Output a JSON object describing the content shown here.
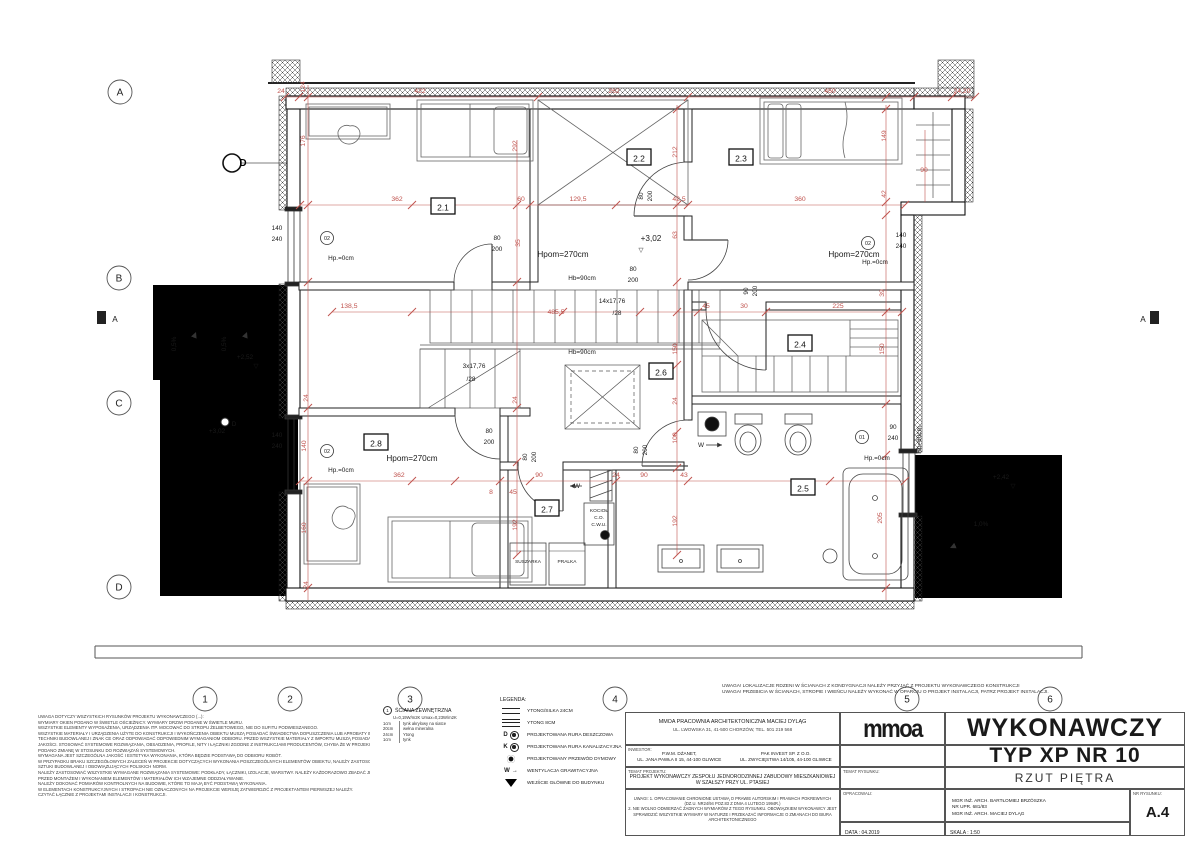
{
  "doc": {
    "office_line1": "MMOA PRACOWNIA ARCHITEKTONICZNA MACIEJ DYLĄG",
    "office_line2": "UL. LWOWSKA 31, 41-500 CHORZÓW, TEL. 501 219 568",
    "logo": "mmoa",
    "inwestor_label": "INWESTOR:",
    "inwestor1_line1": "P.W.M. DŻANET,",
    "inwestor1_line2": "UL. JANA PAWŁA II 15, 44-100 GLIWICE",
    "inwestor2_line1": "PAK INVEST SP. Z O.O.",
    "inwestor2_line2": "UL. ZWYCIĘSTWA 14/105, 44-100 GLIWICE",
    "temat_label": "TEMAT PROJEKTU:",
    "temat_line1": "PROJEKT WYKONAWCZY ZESPOŁU JEDNORODZINNEJ ZABUDOWY MIESZKANIOWEJ",
    "temat_line2": "W SZAŁSZY PRZY UL. PTASIEJ",
    "uwagi_lines": [
      "UWAGI: 1. OPRACOWANIE CHRONIONE USTAWĄ O PRAWIE AUTORSKIM I PRAWACH POKREWNYCH",
      "(DZ.U. NR24/94 POZ.83 Z DNIA 4 LUTEGO 1994R.)",
      "2. NIE WOLNO ODMIERZAĆ ŻADNYCH WYMIARÓW Z TEGO RYSUNKU. OBOWIĄZKIEM WYKONAWCY JEST",
      "SPRAWDZIĆ WSZYSTKIE WYMIARY W NATURZE I PRZEKAZAĆ INFORMACJE O ZMIANACH DO BIURA",
      "ARCHITEKTONICZNEGO"
    ],
    "title_big1": "WYKONAWCZY",
    "title_big2": "TYP XP  NR  10",
    "temat_rys_label": "TEMAT RYSUNKU:",
    "temat_rys": "RZUT PIĘTRA",
    "oprac_label": "OPRACOWALI:",
    "oprac_lines": [
      "MGR INŻ. ARCH. BARTŁOMIEJ BRZÓSZKA",
      "NR UPR. 681/83",
      "MGR INŻ. ARCH. MACIEJ DYLĄG"
    ],
    "nr_rys_label": "NR RYSUNKU:",
    "nr_rys": "A.4",
    "data_label": "DATA :",
    "data_value": "04.2019",
    "skala_label": "SKALA :",
    "skala_value": "1:50"
  },
  "remarks": [
    "UWAGA! LOKALIZACJE RDZENI W ŚCIANACH Z KONDYGNACJI NALEŻY PRZYJĄĆ Z PROJEKTU WYKONAWCZEGO KONSTRUKCJI",
    "UWAGA! PRZEBICIA W ŚCIANACH, STROPIE I WIEŃCU NALEŻY WYKONAĆ W OPARCIU O PROJEKT INSTALACJI, PATRZ PROJEKT INSTALACJI."
  ],
  "notes": [
    "UWAGA DOTYCZY WSZYSTKICH RYSUNKÓW PROJEKTU WYKONAWCZEGO (...):",
    "WYMIARY OKIEN PODANO W ŚWIETLE OŚCIEŻNICY. WYMIARY DRZWI PODANE W ŚWIETLE MURU.",
    "WSZYSTKIE ELEMENTY WYPOSAŻENIA, URZĄDZENIA ITP. MOCOWAĆ DO STROPU ŻELBETOWEGO, NIE DO SUFITU PODWIESZANEGO.",
    "WSZYSTKIE MATERIAŁY I URZĄDZENIA UŻYTE DO KONSTRUKCJI I WYKOŃCZENIA OBIEKTU MUSZĄ POSIADAĆ ŚWIADECTWA DOPUSZCZENIA LUB APROBATY INSTYTUTU",
    "TECHNIKI BUDOWLANEJ I ZNAK CE ORAZ ODPOWIADAĆ ODPOWIEDNIM WYMAGANIOM ODBIORU. PRZED WSZYSTKIE MATERIAŁY Z IMPORTU MUSZĄ POSIADAĆ ŚWIADECTWO",
    "JAKOŚCI. STOSOWAĆ SYSTEMOWE ROZWIĄZANIA, OBSADZENIA, PROFILE, NITY I ŁĄCZNIKI ZGODNE Z INSTRUKCJAMI PRODUCENTÓW, CHYBA ŻE W PROJEKCIE WYRAŹNIE",
    "PODANO ZMIANĘ W STOSUNKU DO ROZWIĄZAŃ SYSTEMOWYCH.",
    "WYMAGANA JEST SZCZEGÓLNA JAKOŚĆ I ESTETYKA WYKONANIA, KTÓRA BĘDZIE PODSTAWĄ DO ODBIORU ROBÓT.",
    "W PRZYPADKU BRAKU SZCZEGÓŁOWYCH ZALECEŃ W PROJEKCIE DOTYCZĄCYCH WYKONANIA POSZCZEGÓLNYCH ELEMENTÓW OBIEKTU, NALEŻY ZASTOSOWAĆ ZASADY",
    "SZTUKI BUDOWLANEJ I OBOWIĄZUJĄCYCH POLSKICH NORM.",
    "NALEŻY ZASTOSOWAĆ WSZYSTKIE WYMAGANE ROZWIĄZANIA SYSTEMOWE: PODKŁADY, ŁĄCZNIKI, IZOLACJE, WARSTWY. NALEŻY KAŻDORAZOWO ZBADAĆ JEDNOŚĆ",
    "PRZED MONTAŻEM I WYKONANIEM ELEMENTÓW I MATERIAŁÓW ICH WZAJEMNE ODDZIAŁYWANIE.",
    "NALEŻY DOKONAĆ POMIARÓW KONTROLNYCH NA BUDOWIE, KTÓRE TO MAJĄ BYĆ PODSTAWĄ WYKONANIA.",
    "W ELEMENTACH KONSTRUKCYJNYCH I STROPACH NIE OZNACZONYCH NA PROJEKCIE WERSJĘ ZATWIERDZIĆ Z PROJEKTANTEM PIERWSZEJ NALEŻY.",
    "CZYTAĆ ŁĄCZNIE Z PROJEKTAMI INSTALACJI I KONSTRUKCJI."
  ],
  "wall_spec": {
    "symbol": "1",
    "title": "ŚCIANA ZEWNĘTRZNA",
    "u_value": "U=0,19W/m2K Umax=0,23W/m2K",
    "layers": [
      [
        "1cm",
        "tynk akrylowy na siatce"
      ],
      [
        "20cm",
        "wełna mineralna"
      ],
      [
        "24cm",
        "Ytong"
      ],
      [
        "1cm",
        "tynk"
      ]
    ]
  },
  "legend": {
    "title": "LEGENDA:",
    "items": [
      {
        "sym": "ytong24",
        "label": "YTONG/SILKA 24CM"
      },
      {
        "sym": "ytong8",
        "label": "YTONG 8CM"
      },
      {
        "sym": "rura-d",
        "label": "PROJEKTOWANA RURA DESZCZOWA"
      },
      {
        "sym": "rura-k",
        "label": "PROJEKTOWANA RURA KANALIZACYJNA"
      },
      {
        "sym": "dym",
        "label": "PROJEKTOWANY PRZEWÓD DYMOWY"
      },
      {
        "sym": "went",
        "label": "WENTYLACJA GRAWITACYJNA"
      },
      {
        "sym": "wejscie",
        "label": "WEJŚCIE GŁÓWNE DO BUDYNKU"
      }
    ]
  },
  "plan": {
    "grid": {
      "rows": [
        {
          "l": "A",
          "x": 120,
          "y": 92
        },
        {
          "l": "B",
          "x": 119,
          "y": 278
        },
        {
          "l": "C",
          "x": 119,
          "y": 403
        },
        {
          "l": "D",
          "x": 119,
          "y": 587
        }
      ],
      "cols": [
        {
          "l": "1",
          "x": 205,
          "y": 699
        },
        {
          "l": "2",
          "x": 290,
          "y": 699
        },
        {
          "l": "3",
          "x": 410,
          "y": 699
        },
        {
          "l": "4",
          "x": 615,
          "y": 699
        },
        {
          "l": "5",
          "x": 907,
          "y": 699
        },
        {
          "l": "6",
          "x": 1050,
          "y": 699
        }
      ]
    },
    "section_label": "A",
    "rooms": [
      {
        "id": "2.1",
        "x": 443,
        "y": 207
      },
      {
        "id": "2.2",
        "x": 639,
        "y": 158
      },
      {
        "id": "2.3",
        "x": 741,
        "y": 158
      },
      {
        "id": "2.4",
        "x": 800,
        "y": 344
      },
      {
        "id": "2.5",
        "x": 803,
        "y": 488
      },
      {
        "id": "2.6",
        "x": 661,
        "y": 372
      },
      {
        "id": "2.7",
        "x": 547,
        "y": 509
      },
      {
        "id": "2.8",
        "x": 376,
        "y": 443
      }
    ],
    "markers": [
      {
        "t": "02",
        "x": 327,
        "y": 238
      },
      {
        "t": "02",
        "x": 327,
        "y": 451
      },
      {
        "t": "02",
        "x": 868,
        "y": 243
      },
      {
        "t": "01",
        "x": 862,
        "y": 437
      }
    ],
    "annotations": [
      {
        "t": "24",
        "x": 281,
        "y": 93,
        "k": "d"
      },
      {
        "t": "422",
        "x": 420,
        "y": 93,
        "k": "d"
      },
      {
        "t": "262",
        "x": 614,
        "y": 93,
        "k": "d"
      },
      {
        "t": "450",
        "x": 830,
        "y": 93,
        "k": "d"
      },
      {
        "t": "24,20",
        "x": 962,
        "y": 93,
        "k": "d"
      },
      {
        "t": "362",
        "x": 397,
        "y": 201,
        "k": "d"
      },
      {
        "t": "60",
        "x": 521,
        "y": 201,
        "k": "d"
      },
      {
        "t": "129,5",
        "x": 578,
        "y": 201,
        "k": "d"
      },
      {
        "t": "42,5",
        "x": 679,
        "y": 201,
        "k": "d"
      },
      {
        "t": "360",
        "x": 800,
        "y": 201,
        "k": "d"
      },
      {
        "t": "90",
        "x": 924,
        "y": 172,
        "k": "d"
      },
      {
        "t": "138,5",
        "x": 349,
        "y": 308,
        "k": "d"
      },
      {
        "t": "485,5",
        "x": 556,
        "y": 314,
        "k": "d"
      },
      {
        "t": "45",
        "x": 706,
        "y": 308,
        "k": "d"
      },
      {
        "t": "30",
        "x": 744,
        "y": 308,
        "k": "d"
      },
      {
        "t": "225",
        "x": 838,
        "y": 308,
        "k": "d"
      },
      {
        "t": "362",
        "x": 399,
        "y": 477,
        "k": "d"
      },
      {
        "t": "90",
        "x": 539,
        "y": 477,
        "k": "d"
      },
      {
        "t": "24",
        "x": 616,
        "y": 477,
        "k": "d"
      },
      {
        "t": "90",
        "x": 644,
        "y": 477,
        "k": "d"
      },
      {
        "t": "43",
        "x": 684,
        "y": 477,
        "k": "d"
      },
      {
        "t": "45",
        "x": 513,
        "y": 494,
        "k": "d"
      },
      {
        "t": "8",
        "x": 491,
        "y": 494,
        "k": "d"
      },
      {
        "t": "124",
        "x": 305,
        "y": 87,
        "k": "d",
        "r": 1
      },
      {
        "t": "176",
        "x": 305,
        "y": 141,
        "k": "d",
        "r": 1
      },
      {
        "t": "292",
        "x": 517,
        "y": 146,
        "k": "d",
        "r": 1
      },
      {
        "t": "35",
        "x": 520,
        "y": 243,
        "k": "d",
        "r": 1
      },
      {
        "t": "212",
        "x": 677,
        "y": 152,
        "k": "d",
        "r": 1
      },
      {
        "t": "63",
        "x": 677,
        "y": 235,
        "k": "d",
        "r": 1
      },
      {
        "t": "150",
        "x": 677,
        "y": 349,
        "k": "d",
        "r": 1
      },
      {
        "t": "24",
        "x": 677,
        "y": 401,
        "k": "d",
        "r": 1
      },
      {
        "t": "100",
        "x": 677,
        "y": 438,
        "k": "d",
        "r": 1
      },
      {
        "t": "192",
        "x": 677,
        "y": 521,
        "k": "d",
        "r": 1
      },
      {
        "t": "140",
        "x": 306,
        "y": 446,
        "k": "d",
        "r": 1
      },
      {
        "t": "160",
        "x": 306,
        "y": 528,
        "k": "d",
        "r": 1
      },
      {
        "t": "24",
        "x": 308,
        "y": 398,
        "k": "d",
        "r": 1
      },
      {
        "t": "24",
        "x": 308,
        "y": 585,
        "k": "d",
        "r": 1
      },
      {
        "t": "192",
        "x": 517,
        "y": 525,
        "k": "d",
        "r": 1
      },
      {
        "t": "24",
        "x": 517,
        "y": 400,
        "k": "d",
        "r": 1
      },
      {
        "t": "149",
        "x": 886,
        "y": 136,
        "k": "d",
        "r": 1
      },
      {
        "t": "42",
        "x": 886,
        "y": 194,
        "k": "d",
        "r": 1
      },
      {
        "t": "39",
        "x": 884,
        "y": 293,
        "k": "d",
        "r": 1
      },
      {
        "t": "150",
        "x": 884,
        "y": 349,
        "k": "d",
        "r": 1
      },
      {
        "t": "205",
        "x": 882,
        "y": 518,
        "k": "d",
        "r": 1
      },
      {
        "t": "80",
        "x": 497,
        "y": 240,
        "k": "b"
      },
      {
        "t": "200",
        "x": 497,
        "y": 251,
        "k": "b"
      },
      {
        "t": "80",
        "x": 633,
        "y": 271,
        "k": "b"
      },
      {
        "t": "200",
        "x": 633,
        "y": 282,
        "k": "b"
      },
      {
        "t": "80",
        "x": 489,
        "y": 433,
        "k": "b"
      },
      {
        "t": "200",
        "x": 489,
        "y": 444,
        "k": "b"
      },
      {
        "t": "80",
        "x": 643,
        "y": 196,
        "k": "b",
        "r": 1
      },
      {
        "t": "200",
        "x": 652,
        "y": 196,
        "k": "b",
        "r": 1
      },
      {
        "t": "90",
        "x": 748,
        "y": 291,
        "k": "b",
        "r": 1
      },
      {
        "t": "200",
        "x": 757,
        "y": 291,
        "k": "b",
        "r": 1
      },
      {
        "t": "80",
        "x": 638,
        "y": 450,
        "k": "b",
        "r": 1
      },
      {
        "t": "200",
        "x": 647,
        "y": 450,
        "k": "b",
        "r": 1
      },
      {
        "t": "80",
        "x": 527,
        "y": 457,
        "k": "b",
        "r": 1
      },
      {
        "t": "200",
        "x": 536,
        "y": 457,
        "k": "b",
        "r": 1
      },
      {
        "t": "140",
        "x": 277,
        "y": 230,
        "k": "b"
      },
      {
        "t": "240",
        "x": 277,
        "y": 241,
        "k": "b"
      },
      {
        "t": "140",
        "x": 277,
        "y": 437,
        "k": "b"
      },
      {
        "t": "240",
        "x": 277,
        "y": 448,
        "k": "b"
      },
      {
        "t": "140",
        "x": 901,
        "y": 237,
        "k": "b"
      },
      {
        "t": "240",
        "x": 901,
        "y": 248,
        "k": "b"
      },
      {
        "t": "90",
        "x": 893,
        "y": 429,
        "k": "b"
      },
      {
        "t": "240",
        "x": 893,
        "y": 440,
        "k": "b"
      },
      {
        "t": "Hp.=0cm",
        "x": 341,
        "y": 260,
        "k": "b"
      },
      {
        "t": "Hp.=0cm",
        "x": 341,
        "y": 472,
        "k": "b"
      },
      {
        "t": "Hp.=0cm",
        "x": 875,
        "y": 264,
        "k": "b"
      },
      {
        "t": "Hp.=0cm",
        "x": 877,
        "y": 460,
        "k": "b"
      },
      {
        "t": "Hpom=270cm",
        "x": 563,
        "y": 257,
        "k": "bl"
      },
      {
        "t": "Hpom=270cm",
        "x": 854,
        "y": 257,
        "k": "bl"
      },
      {
        "t": "Hpom=270cm",
        "x": 412,
        "y": 461,
        "k": "bl"
      },
      {
        "t": "Hb=90cm",
        "x": 582,
        "y": 280,
        "k": "b"
      },
      {
        "t": "Hb=90cm",
        "x": 582,
        "y": 354,
        "k": "b"
      },
      {
        "t": "Hb=80cm",
        "x": 921,
        "y": 440,
        "k": "b",
        "r": 1
      },
      {
        "t": "14x17,76",
        "x": 612,
        "y": 303,
        "k": "b"
      },
      {
        "t": "/28",
        "x": 617,
        "y": 315,
        "k": "b"
      },
      {
        "t": "3x17,76",
        "x": 474,
        "y": 368,
        "k": "b"
      },
      {
        "t": "/28",
        "x": 471,
        "y": 381,
        "k": "b"
      },
      {
        "t": "+3,02",
        "x": 651,
        "y": 241,
        "k": "bl"
      },
      {
        "t": "▽",
        "x": 641,
        "y": 252,
        "k": "b"
      },
      {
        "t": "+3,02",
        "x": 217,
        "y": 433,
        "k": "b"
      },
      {
        "t": "+2,52",
        "x": 245,
        "y": 359,
        "k": "b"
      },
      {
        "t": "▽",
        "x": 256,
        "y": 368,
        "k": "b"
      },
      {
        "t": "+2,42",
        "x": 1001,
        "y": 479,
        "k": "b"
      },
      {
        "t": "▽",
        "x": 1013,
        "y": 488,
        "k": "b"
      },
      {
        "t": "0,5%",
        "x": 176,
        "y": 344,
        "k": "b",
        "r": 1
      },
      {
        "t": "0,5%",
        "x": 226,
        "y": 344,
        "k": "b",
        "r": 1
      },
      {
        "t": "1,0%",
        "x": 981,
        "y": 526,
        "k": "b"
      },
      {
        "t": "W",
        "x": 701,
        "y": 447,
        "k": "b"
      },
      {
        "t": "W",
        "x": 577,
        "y": 488,
        "k": "b"
      },
      {
        "t": "SUSZARKA",
        "x": 528,
        "y": 563,
        "k": "t"
      },
      {
        "t": "PRALKA",
        "x": 567,
        "y": 563,
        "k": "t"
      },
      {
        "t": "KOCIOŁ",
        "x": 599,
        "y": 512,
        "k": "t"
      },
      {
        "t": "C.O.",
        "x": 599,
        "y": 519,
        "k": "t"
      },
      {
        "t": "C.W.U.",
        "x": 599,
        "y": 526,
        "k": "t"
      },
      {
        "t": "D",
        "x": 243,
        "y": 166,
        "k": "bb"
      },
      {
        "t": "D",
        "x": 234,
        "y": 426,
        "k": "b"
      },
      {
        "t": "A",
        "x": 115,
        "y": 322,
        "k": "bl"
      },
      {
        "t": "A",
        "x": 1143,
        "y": 322,
        "k": "bl"
      }
    ]
  }
}
